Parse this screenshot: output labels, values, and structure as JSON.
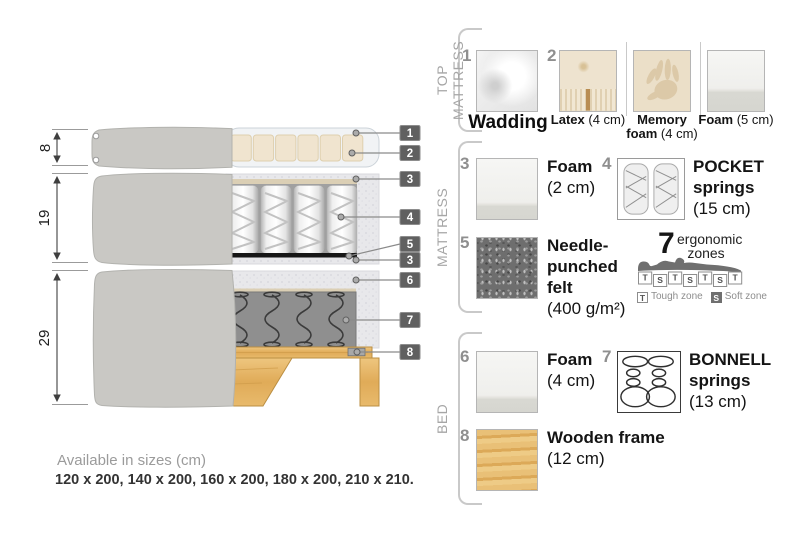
{
  "diagram": {
    "dimensions": [
      "8",
      "19",
      "29"
    ],
    "callouts": [
      "1",
      "2",
      "3",
      "4",
      "5",
      "3",
      "6",
      "7",
      "8"
    ]
  },
  "legend": {
    "top_mattress": {
      "label": "TOP MATTRESS",
      "wadding": {
        "number": "1",
        "name": "Wadding"
      },
      "number2": "2",
      "latex": {
        "name": "Latex",
        "size": "(4 cm)"
      },
      "memory_foam": {
        "name_line1": "Memory",
        "name_line2": "foam",
        "size": "(4 cm)"
      },
      "foam": {
        "name": "Foam",
        "size": "(5 cm)"
      }
    },
    "mattress": {
      "label": "MATTRESS",
      "foam": {
        "number": "3",
        "name": "Foam",
        "size": "(2 cm)"
      },
      "pocket_springs": {
        "number": "4",
        "name_line1": "POCKET",
        "name_line2": "springs",
        "size": "(15 cm)"
      },
      "felt": {
        "number": "5",
        "name_line1": "Needle-",
        "name_line2": "punched",
        "name_line3": "felt",
        "size": "(400 g/m²)"
      },
      "ergonomic": {
        "number": "7",
        "label_line1": "ergonomic",
        "label_line2": "zones",
        "zone_row": [
          "T",
          "S",
          "T",
          "S",
          "T",
          "S",
          "T"
        ],
        "tough_abbr": "T",
        "tough_label": "Tough zone",
        "soft_abbr": "S",
        "soft_label": "Soft zone"
      }
    },
    "bed": {
      "label": "BED",
      "foam": {
        "number": "6",
        "name": "Foam",
        "size": "(4 cm)"
      },
      "bonnell_springs": {
        "number": "7",
        "name_line1": "BONNELL",
        "name_line2": "springs",
        "size": "(13 cm)"
      },
      "wooden_frame": {
        "number": "8",
        "name": "Wooden frame",
        "size": "(12 cm)"
      }
    }
  },
  "footer": {
    "title": "Available in sizes (cm)",
    "sizes": "120 x 200, 140 x 200, 160 x 200, 180 x 200, 210 x 210."
  },
  "colors": {
    "callout_badge": "#606060",
    "fabric_grey": "#c9c8c4",
    "latex_beige": "#f0e4cf",
    "wood": "#e3b469",
    "felt_grey": "#6e6e6e",
    "text_dark": "#1c1c1c",
    "text_grey": "#8f8f8f"
  }
}
